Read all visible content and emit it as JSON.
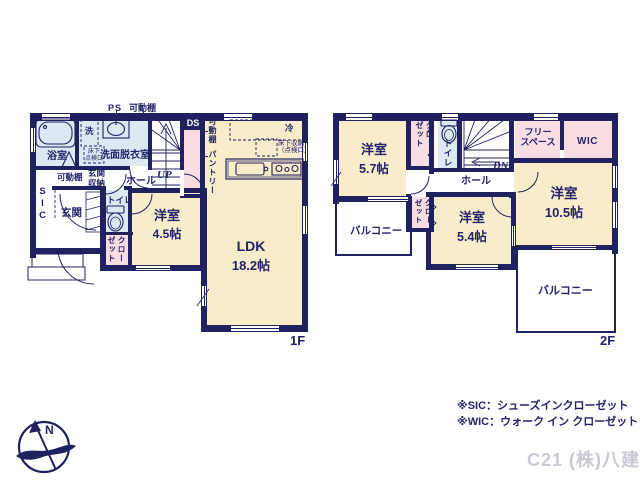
{
  "f1": {
    "floor": "1F",
    "ps": "PS",
    "shelf_top": "可動棚",
    "ds": "DS",
    "bath": "浴室",
    "wash": "洗",
    "inspect1": "床下",
    "inspect2": "点検口",
    "washroom": "洗面脱衣室",
    "shelf_entry": "可動棚",
    "entry_storage1": "玄関",
    "entry_storage2": "収納",
    "hall": "ホール",
    "up": "UP",
    "sic": "SIC",
    "entry": "玄関",
    "toilet": "トイレ",
    "closet": "クローゼット",
    "room45_name": "洋室",
    "room45_size": "4.5帖",
    "ldk_name": "LDK",
    "ldk_size": "18.2帖",
    "shelf_pantry": "可動棚",
    "pantry": "パントリー",
    "fridge": "冷",
    "floor_storage1": "床下収納",
    "floor_storage2": "（点検口）"
  },
  "f2": {
    "floor": "2F",
    "room57_name": "洋室",
    "room57_size": "5.7帖",
    "closet_a": "クローゼット",
    "toilet": "トイレ",
    "dn": "DN",
    "hall": "ホール",
    "free1": "フリー",
    "free2": "スペース",
    "wic": "WIC",
    "room105_name": "洋室",
    "room105_size": "10.5帖",
    "room54_name": "洋室",
    "room54_size": "5.4帖",
    "closet_b": "クローゼット",
    "balcony_l": "バルコニー",
    "balcony_r": "バルコニー"
  },
  "notes": {
    "sic": "※SIC：シューズインクローゼット",
    "wic": "※WIC：ウォーク イン クローゼット"
  },
  "watermark": "C21 (株)八建",
  "compass_n": "N",
  "colors": {
    "wall": "#20215f",
    "room_cream": "#f8ecca",
    "room_blue": "#dce8f2",
    "room_pink": "#f8dee3"
  }
}
